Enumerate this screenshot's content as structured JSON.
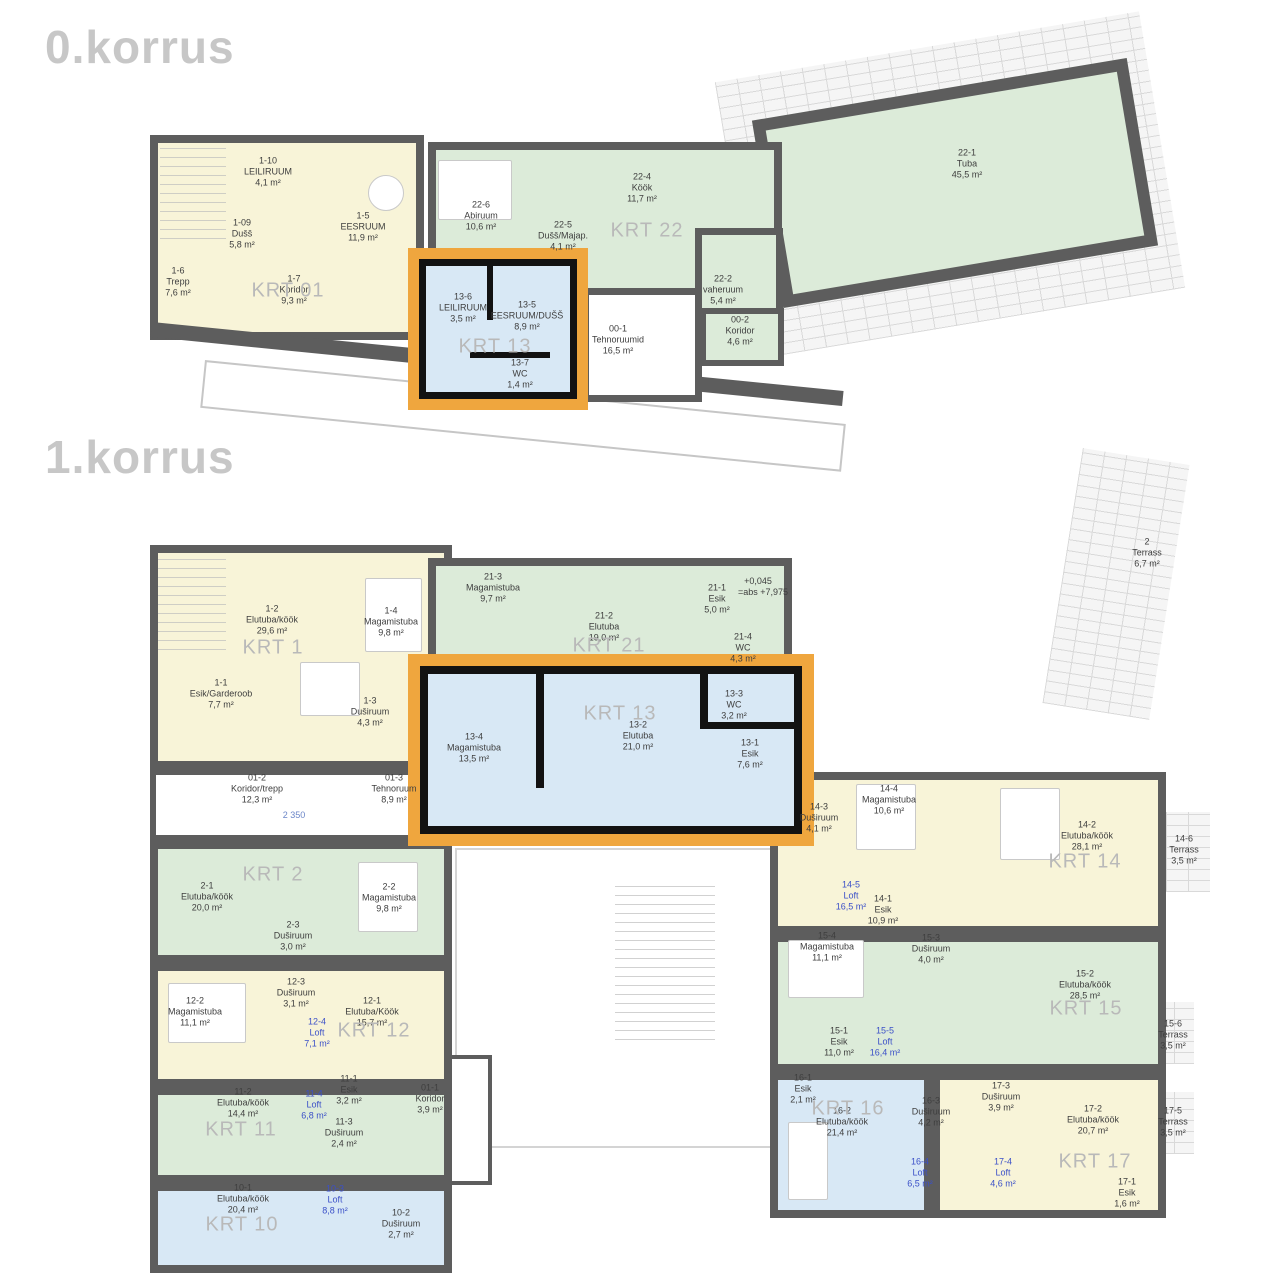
{
  "titles": [
    {
      "text": "0.korrus",
      "x": 45,
      "y": 20
    },
    {
      "text": "1.korrus",
      "x": 45,
      "y": 430
    }
  ],
  "colors": {
    "unit_yellow": "#f8f4d8",
    "unit_green": "#dcebd9",
    "unit_blue": "#d8e8f5",
    "wall": "#5d5d5d",
    "highlight_orange": "#efa63e",
    "loft_text_blue": "#3b50c8",
    "krt_text_gray": "#b9b9b9"
  },
  "floors": [
    {
      "name": "0.korrus",
      "krt_labels": [
        {
          "text": "KRT 01",
          "x": 288,
          "y": 291
        },
        {
          "text": "KRT 13",
          "x": 495,
          "y": 347
        },
        {
          "text": "KRT 22",
          "x": 647,
          "y": 231
        }
      ],
      "rooms": [
        {
          "id": "1-10",
          "name": "LEILIRUUM",
          "area": "4,1 m²",
          "x": 268,
          "y": 172
        },
        {
          "id": "1-09",
          "name": "Dušš",
          "area": "5,8 m²",
          "x": 242,
          "y": 234
        },
        {
          "id": "1-5",
          "name": "EESRUUM",
          "area": "11,9 m²",
          "x": 363,
          "y": 227
        },
        {
          "id": "1-6",
          "name": "Trepp",
          "area": "7,6 m²",
          "x": 178,
          "y": 282
        },
        {
          "id": "1-7",
          "name": "Koridor",
          "area": "9,3 m²",
          "x": 294,
          "y": 290
        },
        {
          "id": "13-6",
          "name": "LEILIRUUM",
          "area": "3,5 m²",
          "x": 463,
          "y": 308
        },
        {
          "id": "13-5",
          "name": "EESRUUM/DUŠŠ",
          "area": "8,9 m²",
          "x": 527,
          "y": 316
        },
        {
          "id": "13-7",
          "name": "WC",
          "area": "1,4 m²",
          "x": 520,
          "y": 374
        },
        {
          "id": "22-6",
          "name": "Abiruum",
          "area": "10,6 m²",
          "x": 481,
          "y": 216
        },
        {
          "id": "22-5",
          "name": "Dušš/Majap.",
          "area": "4,1 m²",
          "x": 563,
          "y": 236
        },
        {
          "id": "22-4",
          "name": "Köök",
          "area": "11,7 m²",
          "x": 642,
          "y": 188
        },
        {
          "id": "22-2",
          "name": "vaheruum",
          "area": "5,4 m²",
          "x": 723,
          "y": 290
        },
        {
          "id": "22-1",
          "name": "Tuba",
          "area": "45,5 m²",
          "x": 967,
          "y": 164
        },
        {
          "id": "00-1",
          "name": "Tehnoruumid",
          "area": "16,5 m²",
          "x": 618,
          "y": 340
        },
        {
          "id": "00-2",
          "name": "Koridor",
          "area": "4,6 m²",
          "x": 740,
          "y": 331
        }
      ],
      "annotations": []
    },
    {
      "name": "1.korrus",
      "krt_labels": [
        {
          "text": "KRT 1",
          "x": 273,
          "y": 648
        },
        {
          "text": "KRT 21",
          "x": 609,
          "y": 646
        },
        {
          "text": "KRT 13",
          "x": 620,
          "y": 714
        },
        {
          "text": "KRT 2",
          "x": 273,
          "y": 875
        },
        {
          "text": "KRT 12",
          "x": 374,
          "y": 1031
        },
        {
          "text": "KRT 11",
          "x": 241,
          "y": 1130
        },
        {
          "text": "KRT 10",
          "x": 242,
          "y": 1225
        },
        {
          "text": "KRT 14",
          "x": 1085,
          "y": 862
        },
        {
          "text": "KRT 15",
          "x": 1086,
          "y": 1009
        },
        {
          "text": "KRT 16",
          "x": 848,
          "y": 1109
        },
        {
          "text": "KRT 17",
          "x": 1095,
          "y": 1162
        }
      ],
      "rooms": [
        {
          "id": "1-2",
          "name": "Elutuba/köök",
          "area": "29,6 m²",
          "x": 272,
          "y": 620
        },
        {
          "id": "1-4",
          "name": "Magamistuba",
          "area": "9,8 m²",
          "x": 391,
          "y": 622
        },
        {
          "id": "1-1",
          "name": "Esik/Garderoob",
          "area": "7,7 m²",
          "x": 221,
          "y": 694
        },
        {
          "id": "1-3",
          "name": "Duširuum",
          "area": "4,3 m²",
          "x": 370,
          "y": 712
        },
        {
          "id": "21-3",
          "name": "Magamistuba",
          "area": "9,7 m²",
          "x": 493,
          "y": 588
        },
        {
          "id": "21-2",
          "name": "Elutuba",
          "area": "19,0 m²",
          "x": 604,
          "y": 627
        },
        {
          "id": "21-1",
          "name": "Esik",
          "area": "5,0 m²",
          "x": 717,
          "y": 599
        },
        {
          "id": "21-4",
          "name": "WC",
          "area": "4,3 m²",
          "x": 743,
          "y": 648
        },
        {
          "id": "13-4",
          "name": "Magamistuba",
          "area": "13,5 m²",
          "x": 474,
          "y": 748
        },
        {
          "id": "13-2",
          "name": "Elutuba",
          "area": "21,0 m²",
          "x": 638,
          "y": 736
        },
        {
          "id": "13-3",
          "name": "WC",
          "area": "3,2 m²",
          "x": 734,
          "y": 705
        },
        {
          "id": "13-1",
          "name": "Esik",
          "area": "7,6 m²",
          "x": 750,
          "y": 754
        },
        {
          "id": "01-2",
          "name": "Koridor/trepp",
          "area": "12,3 m²",
          "x": 257,
          "y": 789
        },
        {
          "id": "01-3",
          "name": "Tehnoruum",
          "area": "8,9 m²",
          "x": 394,
          "y": 789
        },
        {
          "id": "01-1",
          "name": "Koridor",
          "area": "3,9 m²",
          "x": 430,
          "y": 1099
        },
        {
          "id": "2",
          "name": "Terrass",
          "area": "6,7 m²",
          "x": 1147,
          "y": 553
        },
        {
          "id": "2-1",
          "name": "Elutuba/köök",
          "area": "20,0 m²",
          "x": 207,
          "y": 897
        },
        {
          "id": "2-2",
          "name": "Magamistuba",
          "area": "9,8 m²",
          "x": 389,
          "y": 898
        },
        {
          "id": "2-3",
          "name": "Duširuum",
          "area": "3,0 m²",
          "x": 293,
          "y": 936
        },
        {
          "id": "12-2",
          "name": "Magamistuba",
          "area": "11,1 m²",
          "x": 195,
          "y": 1012
        },
        {
          "id": "12-3",
          "name": "Duširuum",
          "area": "3,1 m²",
          "x": 296,
          "y": 993
        },
        {
          "id": "12-4",
          "name": "Loft",
          "area": "7,1 m²",
          "x": 317,
          "y": 1033,
          "accent": true
        },
        {
          "id": "12-1",
          "name": "Elutuba/Köök",
          "area": "15,7 m²",
          "x": 372,
          "y": 1012
        },
        {
          "id": "11-2",
          "name": "Elutuba/köök",
          "area": "14,4 m²",
          "x": 243,
          "y": 1103
        },
        {
          "id": "11-4",
          "name": "Loft",
          "area": "6,8 m²",
          "x": 314,
          "y": 1105,
          "accent": true
        },
        {
          "id": "11-1",
          "name": "Esik",
          "area": "3,2 m²",
          "x": 349,
          "y": 1090
        },
        {
          "id": "11-3",
          "name": "Duširuum",
          "area": "2,4 m²",
          "x": 344,
          "y": 1133
        },
        {
          "id": "10-1",
          "name": "Elutuba/köök",
          "area": "20,4 m²",
          "x": 243,
          "y": 1199
        },
        {
          "id": "10-3",
          "name": "Loft",
          "area": "8,8 m²",
          "x": 335,
          "y": 1200,
          "accent": true
        },
        {
          "id": "10-2",
          "name": "Duširuum",
          "area": "2,7 m²",
          "x": 401,
          "y": 1224
        },
        {
          "id": "14-3",
          "name": "Duširuum",
          "area": "4,1 m²",
          "x": 819,
          "y": 818
        },
        {
          "id": "14-4",
          "name": "Magamistuba",
          "area": "10,6 m²",
          "x": 889,
          "y": 800
        },
        {
          "id": "14-2",
          "name": "Elutuba/köök",
          "area": "28,1 m²",
          "x": 1087,
          "y": 836
        },
        {
          "id": "14-5",
          "name": "Loft",
          "area": "16,5 m²",
          "x": 851,
          "y": 896,
          "accent": true
        },
        {
          "id": "14-1",
          "name": "Esik",
          "area": "10,9 m²",
          "x": 883,
          "y": 910
        },
        {
          "id": "14-6",
          "name": "Terrass",
          "area": "3,5 m²",
          "x": 1184,
          "y": 850
        },
        {
          "id": "15-4",
          "name": "Magamistuba",
          "area": "11,1 m²",
          "x": 827,
          "y": 947
        },
        {
          "id": "15-3",
          "name": "Duširuum",
          "area": "4,0 m²",
          "x": 931,
          "y": 949
        },
        {
          "id": "15-2",
          "name": "Elutuba/köök",
          "area": "28,5 m²",
          "x": 1085,
          "y": 985
        },
        {
          "id": "15-1",
          "name": "Esik",
          "area": "11,0 m²",
          "x": 839,
          "y": 1042
        },
        {
          "id": "15-5",
          "name": "Loft",
          "area": "16,4 m²",
          "x": 885,
          "y": 1042,
          "accent": true
        },
        {
          "id": "15-6",
          "name": "Terrass",
          "area": "3,5 m²",
          "x": 1173,
          "y": 1035
        },
        {
          "id": "16-1",
          "name": "Esik",
          "area": "2,1 m²",
          "x": 803,
          "y": 1089
        },
        {
          "id": "16-2",
          "name": "Elutuba/köök",
          "area": "21,4 m²",
          "x": 842,
          "y": 1122
        },
        {
          "id": "16-3",
          "name": "Duširuum",
          "area": "4,2 m²",
          "x": 931,
          "y": 1112
        },
        {
          "id": "16-4",
          "name": "Loft",
          "area": "6,5 m²",
          "x": 920,
          "y": 1173,
          "accent": true
        },
        {
          "id": "17-3",
          "name": "Duširuum",
          "area": "3,9 m²",
          "x": 1001,
          "y": 1097
        },
        {
          "id": "17-2",
          "name": "Elutuba/köök",
          "area": "20,7 m²",
          "x": 1093,
          "y": 1120
        },
        {
          "id": "17-4",
          "name": "Loft",
          "area": "4,6 m²",
          "x": 1003,
          "y": 1173,
          "accent": true
        },
        {
          "id": "17-1",
          "name": "Esik",
          "area": "1,6 m²",
          "x": 1127,
          "y": 1193
        },
        {
          "id": "17-5",
          "name": "Terrass",
          "area": "3,5 m²",
          "x": 1173,
          "y": 1122
        }
      ],
      "annotations": [
        {
          "text": "+0,045",
          "x": 758,
          "y": 581,
          "kind": "level"
        },
        {
          "text": "=abs +7,975",
          "x": 763,
          "y": 592,
          "kind": "level"
        },
        {
          "text": "2 350",
          "x": 294,
          "y": 815,
          "kind": "dim"
        }
      ]
    }
  ]
}
